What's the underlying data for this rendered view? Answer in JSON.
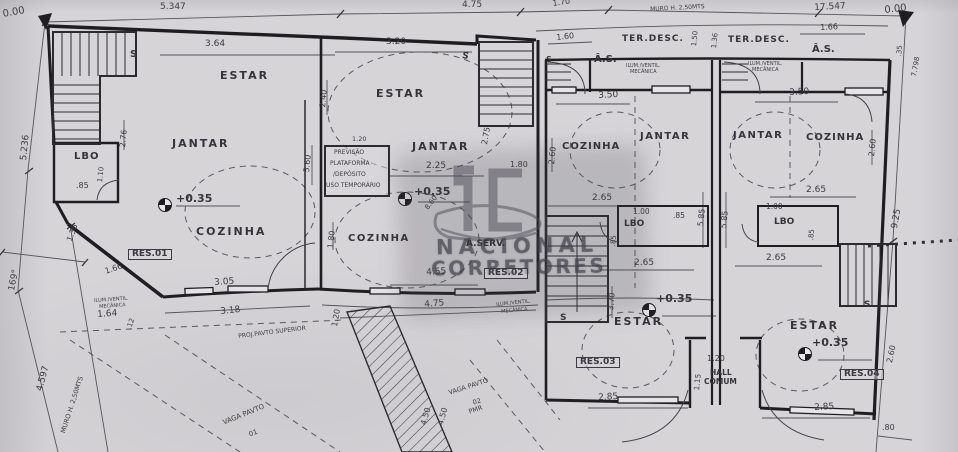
{
  "watermark": {
    "monogram": "IC",
    "line1": "NACIONAL",
    "line2": "CORRETORES"
  },
  "labels": [
    {
      "text": "0.00",
      "x": 2,
      "y": 10,
      "s": 10,
      "r": -10,
      "name": "level-ref-label"
    },
    {
      "text": "5.347",
      "x": 160,
      "y": 3,
      "s": 9,
      "name": "dim-label"
    },
    {
      "text": "4.75",
      "x": 462,
      "y": 1,
      "s": 9,
      "name": "dim-label"
    },
    {
      "text": "1.70",
      "x": 552,
      "y": 0,
      "s": 8,
      "r": -8,
      "name": "dim-label"
    },
    {
      "text": "MURO H. 2,50MTS",
      "x": 650,
      "y": 7,
      "s": 6,
      "r": -3,
      "name": "wall-note-label"
    },
    {
      "text": "17.547",
      "x": 814,
      "y": 4,
      "s": 9,
      "r": -3,
      "name": "dim-label"
    },
    {
      "text": "0.00",
      "x": 884,
      "y": 6,
      "s": 10,
      "r": -6,
      "name": "level-ref-label"
    },
    {
      "text": "5.236",
      "x": 20,
      "y": 160,
      "s": 9,
      "r": -84,
      "name": "dim-label"
    },
    {
      "text": "169°",
      "x": 8,
      "y": 290,
      "s": 9,
      "r": -78,
      "name": "angle-label"
    },
    {
      "text": "4.597",
      "x": 36,
      "y": 390,
      "s": 9,
      "r": -75,
      "name": "dim-label"
    },
    {
      "text": "MURO H. 2,50MTS",
      "x": 60,
      "y": 432,
      "s": 6.5,
      "r": -72,
      "name": "wall-note-label"
    },
    {
      "text": "3.64",
      "x": 205,
      "y": 40,
      "s": 9,
      "name": "dim-label"
    },
    {
      "text": "ESTAR",
      "x": 220,
      "y": 70,
      "s": 11,
      "ls": 2,
      "cls": "room",
      "name": "room-label-estar"
    },
    {
      "text": "S",
      "x": 130,
      "y": 50,
      "s": 10,
      "cls": "room",
      "name": "stair-label"
    },
    {
      "text": "JANTAR",
      "x": 172,
      "y": 138,
      "s": 11,
      "ls": 2,
      "cls": "room",
      "name": "room-label-jantar"
    },
    {
      "text": "2.76",
      "x": 119,
      "y": 147,
      "s": 8,
      "r": -84,
      "name": "dim-label"
    },
    {
      "text": "LBO",
      "x": 74,
      "y": 152,
      "s": 10,
      "ls": 1,
      "cls": "room",
      "name": "room-label-lbo"
    },
    {
      "text": "1.10",
      "x": 97,
      "y": 182,
      "s": 7,
      "r": -84,
      "name": "dim-label"
    },
    {
      "text": ".85",
      "x": 76,
      "y": 182,
      "s": 8,
      "name": "dim-label"
    },
    {
      "text": "+0.35",
      "x": 176,
      "y": 193,
      "s": 11,
      "cls": "room",
      "name": "level-label"
    },
    {
      "text": "COZINHA",
      "x": 196,
      "y": 226,
      "s": 11,
      "ls": 2,
      "cls": "room",
      "name": "room-label-cozinha"
    },
    {
      "text": "RES.01",
      "x": 128,
      "y": 249,
      "s": 9,
      "cls": "unit",
      "name": "unit-label-res01"
    },
    {
      "text": "1.66",
      "x": 104,
      "y": 268,
      "s": 8,
      "r": -18,
      "name": "dim-label"
    },
    {
      "text": "1.36",
      "x": 66,
      "y": 240,
      "s": 8,
      "r": -70,
      "name": "dim-label"
    },
    {
      "text": "3.05",
      "x": 214,
      "y": 279,
      "s": 9,
      "r": -4,
      "name": "dim-label"
    },
    {
      "text": "ILUM./VENTIL.",
      "x": 94,
      "y": 299,
      "s": 5,
      "r": -4,
      "cls": "tiny",
      "name": "vent-note-label"
    },
    {
      "text": "MECÂNICA",
      "x": 99,
      "y": 305,
      "s": 5,
      "r": -4,
      "cls": "tiny",
      "name": "vent-note-label"
    },
    {
      "text": "1.64",
      "x": 97,
      "y": 311,
      "s": 9,
      "r": -4,
      "name": "dim-label"
    },
    {
      "text": "3.18",
      "x": 220,
      "y": 308,
      "s": 9,
      "r": -6,
      "name": "dim-label"
    },
    {
      "text": ".12",
      "x": 126,
      "y": 328,
      "s": 7,
      "r": -70,
      "name": "dim-label"
    },
    {
      "text": "3.20",
      "x": 386,
      "y": 38,
      "s": 9,
      "name": "dim-label"
    },
    {
      "text": "2.40",
      "x": 319,
      "y": 107,
      "s": 8,
      "r": -84,
      "name": "dim-label"
    },
    {
      "text": "ESTAR",
      "x": 376,
      "y": 88,
      "s": 11,
      "ls": 2,
      "cls": "room",
      "name": "room-label-estar"
    },
    {
      "text": "S",
      "x": 463,
      "y": 52,
      "s": 9,
      "r": 12,
      "cls": "room",
      "name": "stair-label"
    },
    {
      "text": "2.75",
      "x": 481,
      "y": 144,
      "s": 8,
      "r": -80,
      "name": "dim-label"
    },
    {
      "text": "1.20",
      "x": 352,
      "y": 136,
      "s": 6.5,
      "name": "dim-label"
    },
    {
      "text": "PREVISÃO",
      "x": 334,
      "y": 150,
      "s": 6,
      "cls": "tiny",
      "name": "note-label"
    },
    {
      "text": "PLATAFORMA",
      "x": 330,
      "y": 161,
      "s": 6,
      "cls": "tiny",
      "name": "note-label"
    },
    {
      "text": "/DEPÓSITO",
      "x": 333,
      "y": 172,
      "s": 6,
      "cls": "tiny",
      "name": "note-label"
    },
    {
      "text": "USO TEMPORÁRIO",
      "x": 326,
      "y": 183,
      "s": 6,
      "cls": "tiny",
      "name": "note-label"
    },
    {
      "text": "JANTAR",
      "x": 412,
      "y": 141,
      "s": 11,
      "ls": 2,
      "cls": "room",
      "name": "room-label-jantar"
    },
    {
      "text": "2.25",
      "x": 426,
      "y": 162,
      "s": 9,
      "name": "dim-label"
    },
    {
      "text": "1.80",
      "x": 510,
      "y": 161,
      "s": 8,
      "name": "dim-label"
    },
    {
      "text": "+0.35",
      "x": 414,
      "y": 186,
      "s": 11,
      "cls": "room",
      "name": "level-label"
    },
    {
      "text": "8.60",
      "x": 424,
      "y": 207,
      "s": 7,
      "r": -52,
      "name": "dim-label"
    },
    {
      "text": "5.60",
      "x": 303,
      "y": 172,
      "s": 8,
      "r": -84,
      "name": "dim-label"
    },
    {
      "text": "1.80",
      "x": 327,
      "y": 248,
      "s": 8,
      "r": -84,
      "name": "dim-label"
    },
    {
      "text": "COZINHA",
      "x": 348,
      "y": 234,
      "s": 10,
      "ls": 1.5,
      "cls": "room",
      "name": "room-label-cozinha"
    },
    {
      "text": "Â.SERV.",
      "x": 466,
      "y": 240,
      "s": 9,
      "cls": "room",
      "name": "room-label-aserv"
    },
    {
      "text": "4.55",
      "x": 426,
      "y": 269,
      "s": 9,
      "r": -4,
      "name": "dim-label"
    },
    {
      "text": "RES.02",
      "x": 484,
      "y": 268,
      "s": 9,
      "cls": "unit",
      "name": "unit-label-res02"
    },
    {
      "text": "4.75",
      "x": 424,
      "y": 301,
      "s": 9,
      "r": -5,
      "name": "dim-label"
    },
    {
      "text": "ILUM./VENTIL.",
      "x": 496,
      "y": 303,
      "s": 5,
      "r": -6,
      "cls": "tiny",
      "name": "vent-note-label"
    },
    {
      "text": "MECÂNICA",
      "x": 501,
      "y": 310,
      "s": 5,
      "r": -6,
      "cls": "tiny",
      "name": "vent-note-label"
    },
    {
      "text": "1.20",
      "x": 331,
      "y": 326,
      "s": 8,
      "r": -80,
      "name": "dim-label"
    },
    {
      "text": "PROJ.PAVTO SUPERIOR",
      "x": 238,
      "y": 334,
      "s": 6,
      "r": -7,
      "cls": "tiny",
      "name": "projection-note-label"
    },
    {
      "text": "VAGA PAVTO",
      "x": 448,
      "y": 390,
      "s": 6.5,
      "r": -18,
      "cls": "tiny",
      "name": "parking-label"
    },
    {
      "text": "02",
      "x": 472,
      "y": 400,
      "s": 6.5,
      "r": -18,
      "cls": "tiny",
      "name": "parking-label"
    },
    {
      "text": "PMR",
      "x": 468,
      "y": 409,
      "s": 6.5,
      "r": -18,
      "cls": "tiny",
      "name": "parking-label"
    },
    {
      "text": "4.50",
      "x": 420,
      "y": 424,
      "s": 8,
      "r": -75,
      "name": "dim-label"
    },
    {
      "text": "4.50",
      "x": 437,
      "y": 424,
      "s": 8,
      "r": -75,
      "name": "dim-label"
    },
    {
      "text": "VAGA PAVTO",
      "x": 222,
      "y": 420,
      "s": 7,
      "r": -22,
      "cls": "tiny",
      "name": "parking-label"
    },
    {
      "text": "01",
      "x": 248,
      "y": 432,
      "s": 7,
      "r": -22,
      "cls": "tiny",
      "name": "parking-label"
    },
    {
      "text": "1.60",
      "x": 556,
      "y": 34,
      "s": 8,
      "r": -6,
      "name": "dim-label"
    },
    {
      "text": "S",
      "x": 546,
      "y": 56,
      "s": 8,
      "cls": "room",
      "name": "stair-label"
    },
    {
      "text": "Â.S.",
      "x": 594,
      "y": 55,
      "s": 10,
      "cls": "room",
      "name": "room-label-as"
    },
    {
      "text": "TER.DESC.",
      "x": 622,
      "y": 35,
      "s": 9,
      "ls": 1,
      "cls": "room",
      "name": "room-label-terdesc"
    },
    {
      "text": "ILUM./VENTIL.",
      "x": 626,
      "y": 64,
      "s": 5,
      "cls": "tiny",
      "name": "vent-note-label"
    },
    {
      "text": "MECÂNICA",
      "x": 630,
      "y": 70,
      "s": 5,
      "cls": "tiny",
      "name": "vent-note-label"
    },
    {
      "text": "1.50",
      "x": 691,
      "y": 46,
      "s": 7,
      "r": -84,
      "name": "dim-label"
    },
    {
      "text": "1.36",
      "x": 711,
      "y": 48,
      "s": 7,
      "r": -84,
      "name": "dim-label"
    },
    {
      "text": "TER.DESC.",
      "x": 728,
      "y": 36,
      "s": 9,
      "ls": 1,
      "cls": "room",
      "name": "room-label-terdesc"
    },
    {
      "text": "ILUM./VENTIL.",
      "x": 748,
      "y": 62,
      "s": 5,
      "cls": "tiny",
      "name": "vent-note-label"
    },
    {
      "text": "MECÂNICA",
      "x": 752,
      "y": 68,
      "s": 5,
      "cls": "tiny",
      "name": "vent-note-label"
    },
    {
      "text": "1.66",
      "x": 820,
      "y": 24,
      "s": 8,
      "r": -3,
      "name": "dim-label"
    },
    {
      "text": "Â.S.",
      "x": 812,
      "y": 45,
      "s": 10,
      "cls": "room",
      "name": "room-label-as"
    },
    {
      "text": ".35",
      "x": 896,
      "y": 56,
      "s": 7,
      "r": -84,
      "name": "dim-label"
    },
    {
      "text": "7.798",
      "x": 911,
      "y": 76,
      "s": 7,
      "r": -80,
      "name": "dim-label"
    },
    {
      "text": "3.50",
      "x": 598,
      "y": 92,
      "s": 9,
      "r": -3,
      "name": "dim-label"
    },
    {
      "text": "2.60",
      "x": 548,
      "y": 164,
      "s": 8,
      "r": -84,
      "name": "dim-label"
    },
    {
      "text": "COZINHA",
      "x": 562,
      "y": 142,
      "s": 10,
      "ls": 1,
      "cls": "room",
      "name": "room-label-cozinha"
    },
    {
      "text": "JANTAR",
      "x": 640,
      "y": 132,
      "s": 10,
      "ls": 1.5,
      "cls": "room",
      "name": "room-label-jantar"
    },
    {
      "text": "2.65",
      "x": 592,
      "y": 194,
      "s": 9,
      "name": "dim-label"
    },
    {
      "text": "1.00",
      "x": 633,
      "y": 208,
      "s": 7.5,
      "name": "dim-label"
    },
    {
      "text": "LBO",
      "x": 624,
      "y": 220,
      "s": 9,
      "cls": "room",
      "name": "room-label-lbo"
    },
    {
      "text": ".85",
      "x": 673,
      "y": 212,
      "s": 7.5,
      "name": "dim-label"
    },
    {
      "text": ".85",
      "x": 610,
      "y": 246,
      "s": 7,
      "r": -84,
      "name": "dim-label"
    },
    {
      "text": "5.85",
      "x": 697,
      "y": 226,
      "s": 8,
      "r": -84,
      "name": "dim-label"
    },
    {
      "text": "5.85",
      "x": 720,
      "y": 228,
      "s": 8,
      "r": -84,
      "name": "dim-label"
    },
    {
      "text": "2.65",
      "x": 634,
      "y": 259,
      "s": 9,
      "name": "dim-label"
    },
    {
      "text": "3.70",
      "x": 607,
      "y": 310,
      "s": 8,
      "r": -84,
      "name": "dim-label"
    },
    {
      "text": "S",
      "x": 560,
      "y": 314,
      "s": 9,
      "cls": "room",
      "name": "stair-label"
    },
    {
      "text": "ESTAR",
      "x": 614,
      "y": 316,
      "s": 11,
      "ls": 2,
      "cls": "room",
      "name": "room-label-estar"
    },
    {
      "text": "+0.35",
      "x": 656,
      "y": 293,
      "s": 11,
      "cls": "room",
      "name": "level-label"
    },
    {
      "text": "RES.03",
      "x": 576,
      "y": 357,
      "s": 9,
      "cls": "unit",
      "name": "unit-label-res03"
    },
    {
      "text": "2.85",
      "x": 598,
      "y": 394,
      "s": 9,
      "r": -3,
      "name": "dim-label"
    },
    {
      "text": "1.20",
      "x": 707,
      "y": 355,
      "s": 8,
      "name": "dim-label"
    },
    {
      "text": "1.15",
      "x": 693,
      "y": 390,
      "s": 7.5,
      "r": -84,
      "name": "dim-label"
    },
    {
      "text": "HALL",
      "x": 710,
      "y": 369,
      "s": 7.5,
      "cls": "room",
      "name": "room-label-hall"
    },
    {
      "text": "COMUM",
      "x": 704,
      "y": 378,
      "s": 7.5,
      "cls": "room",
      "name": "room-label-hall"
    },
    {
      "text": "3.50",
      "x": 789,
      "y": 89,
      "s": 9,
      "r": -3,
      "name": "dim-label"
    },
    {
      "text": "JANTAR",
      "x": 733,
      "y": 131,
      "s": 10,
      "ls": 1.5,
      "cls": "room",
      "name": "room-label-jantar"
    },
    {
      "text": "COZINHA",
      "x": 806,
      "y": 133,
      "s": 10,
      "ls": 1,
      "cls": "room",
      "name": "room-label-cozinha"
    },
    {
      "text": "2.60",
      "x": 868,
      "y": 156,
      "s": 8,
      "r": -84,
      "name": "dim-label"
    },
    {
      "text": "2.65",
      "x": 806,
      "y": 186,
      "s": 9,
      "name": "dim-label"
    },
    {
      "text": "1.00",
      "x": 766,
      "y": 203,
      "s": 7.5,
      "name": "dim-label"
    },
    {
      "text": "LBO",
      "x": 774,
      "y": 218,
      "s": 9,
      "cls": "room",
      "name": "room-label-lbo"
    },
    {
      "text": ".85",
      "x": 808,
      "y": 240,
      "s": 7,
      "r": -84,
      "name": "dim-label"
    },
    {
      "text": "2.65",
      "x": 766,
      "y": 254,
      "s": 9,
      "name": "dim-label"
    },
    {
      "text": "S",
      "x": 864,
      "y": 301,
      "s": 9,
      "cls": "room",
      "name": "stair-label"
    },
    {
      "text": "2.60",
      "x": 886,
      "y": 362,
      "s": 8,
      "r": -78,
      "name": "dim-label"
    },
    {
      "text": "ESTAR",
      "x": 790,
      "y": 320,
      "s": 11,
      "ls": 2,
      "cls": "room",
      "name": "room-label-estar"
    },
    {
      "text": "+0.35",
      "x": 812,
      "y": 337,
      "s": 11,
      "cls": "room",
      "name": "level-label"
    },
    {
      "text": "RES.04",
      "x": 840,
      "y": 369,
      "s": 9,
      "cls": "unit",
      "name": "unit-label-res04"
    },
    {
      "text": "2.85",
      "x": 814,
      "y": 404,
      "s": 9,
      "r": -3,
      "name": "dim-label"
    },
    {
      "text": ".80",
      "x": 882,
      "y": 424,
      "s": 8,
      "name": "dim-label"
    },
    {
      "text": "9.25",
      "x": 891,
      "y": 228,
      "s": 9,
      "r": -80,
      "name": "dim-label"
    }
  ]
}
